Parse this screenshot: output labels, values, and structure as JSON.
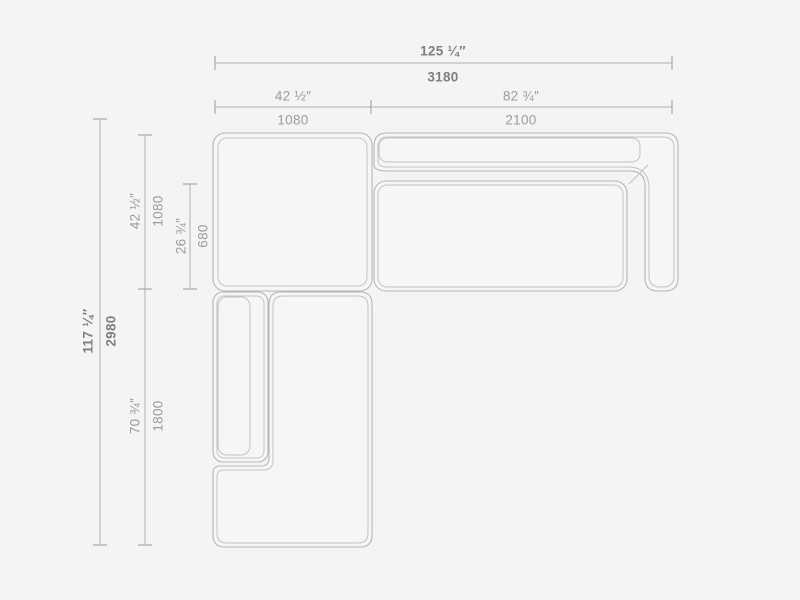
{
  "colors": {
    "background": "#f4f4f4",
    "line_work": "#b7b7b7",
    "dimension_text": "#9b9b9b",
    "dimension_text_bold": "#7f7f7f"
  },
  "dims": {
    "overall_width": {
      "in": "125 ¼″",
      "mm": "3180"
    },
    "module_a_width": {
      "in": "42 ½″",
      "mm": "1080"
    },
    "module_b_width": {
      "in": "82 ¾″",
      "mm": "2100"
    },
    "overall_depth": {
      "in": "117 ¼″",
      "mm": "2980"
    },
    "module_a_depth": {
      "in": "42 ½″",
      "mm": "1080"
    },
    "seat_depth": {
      "in": "26 ¾″",
      "mm": "680"
    },
    "chaise_length": {
      "in": "70 ¾″",
      "mm": "1800"
    }
  }
}
